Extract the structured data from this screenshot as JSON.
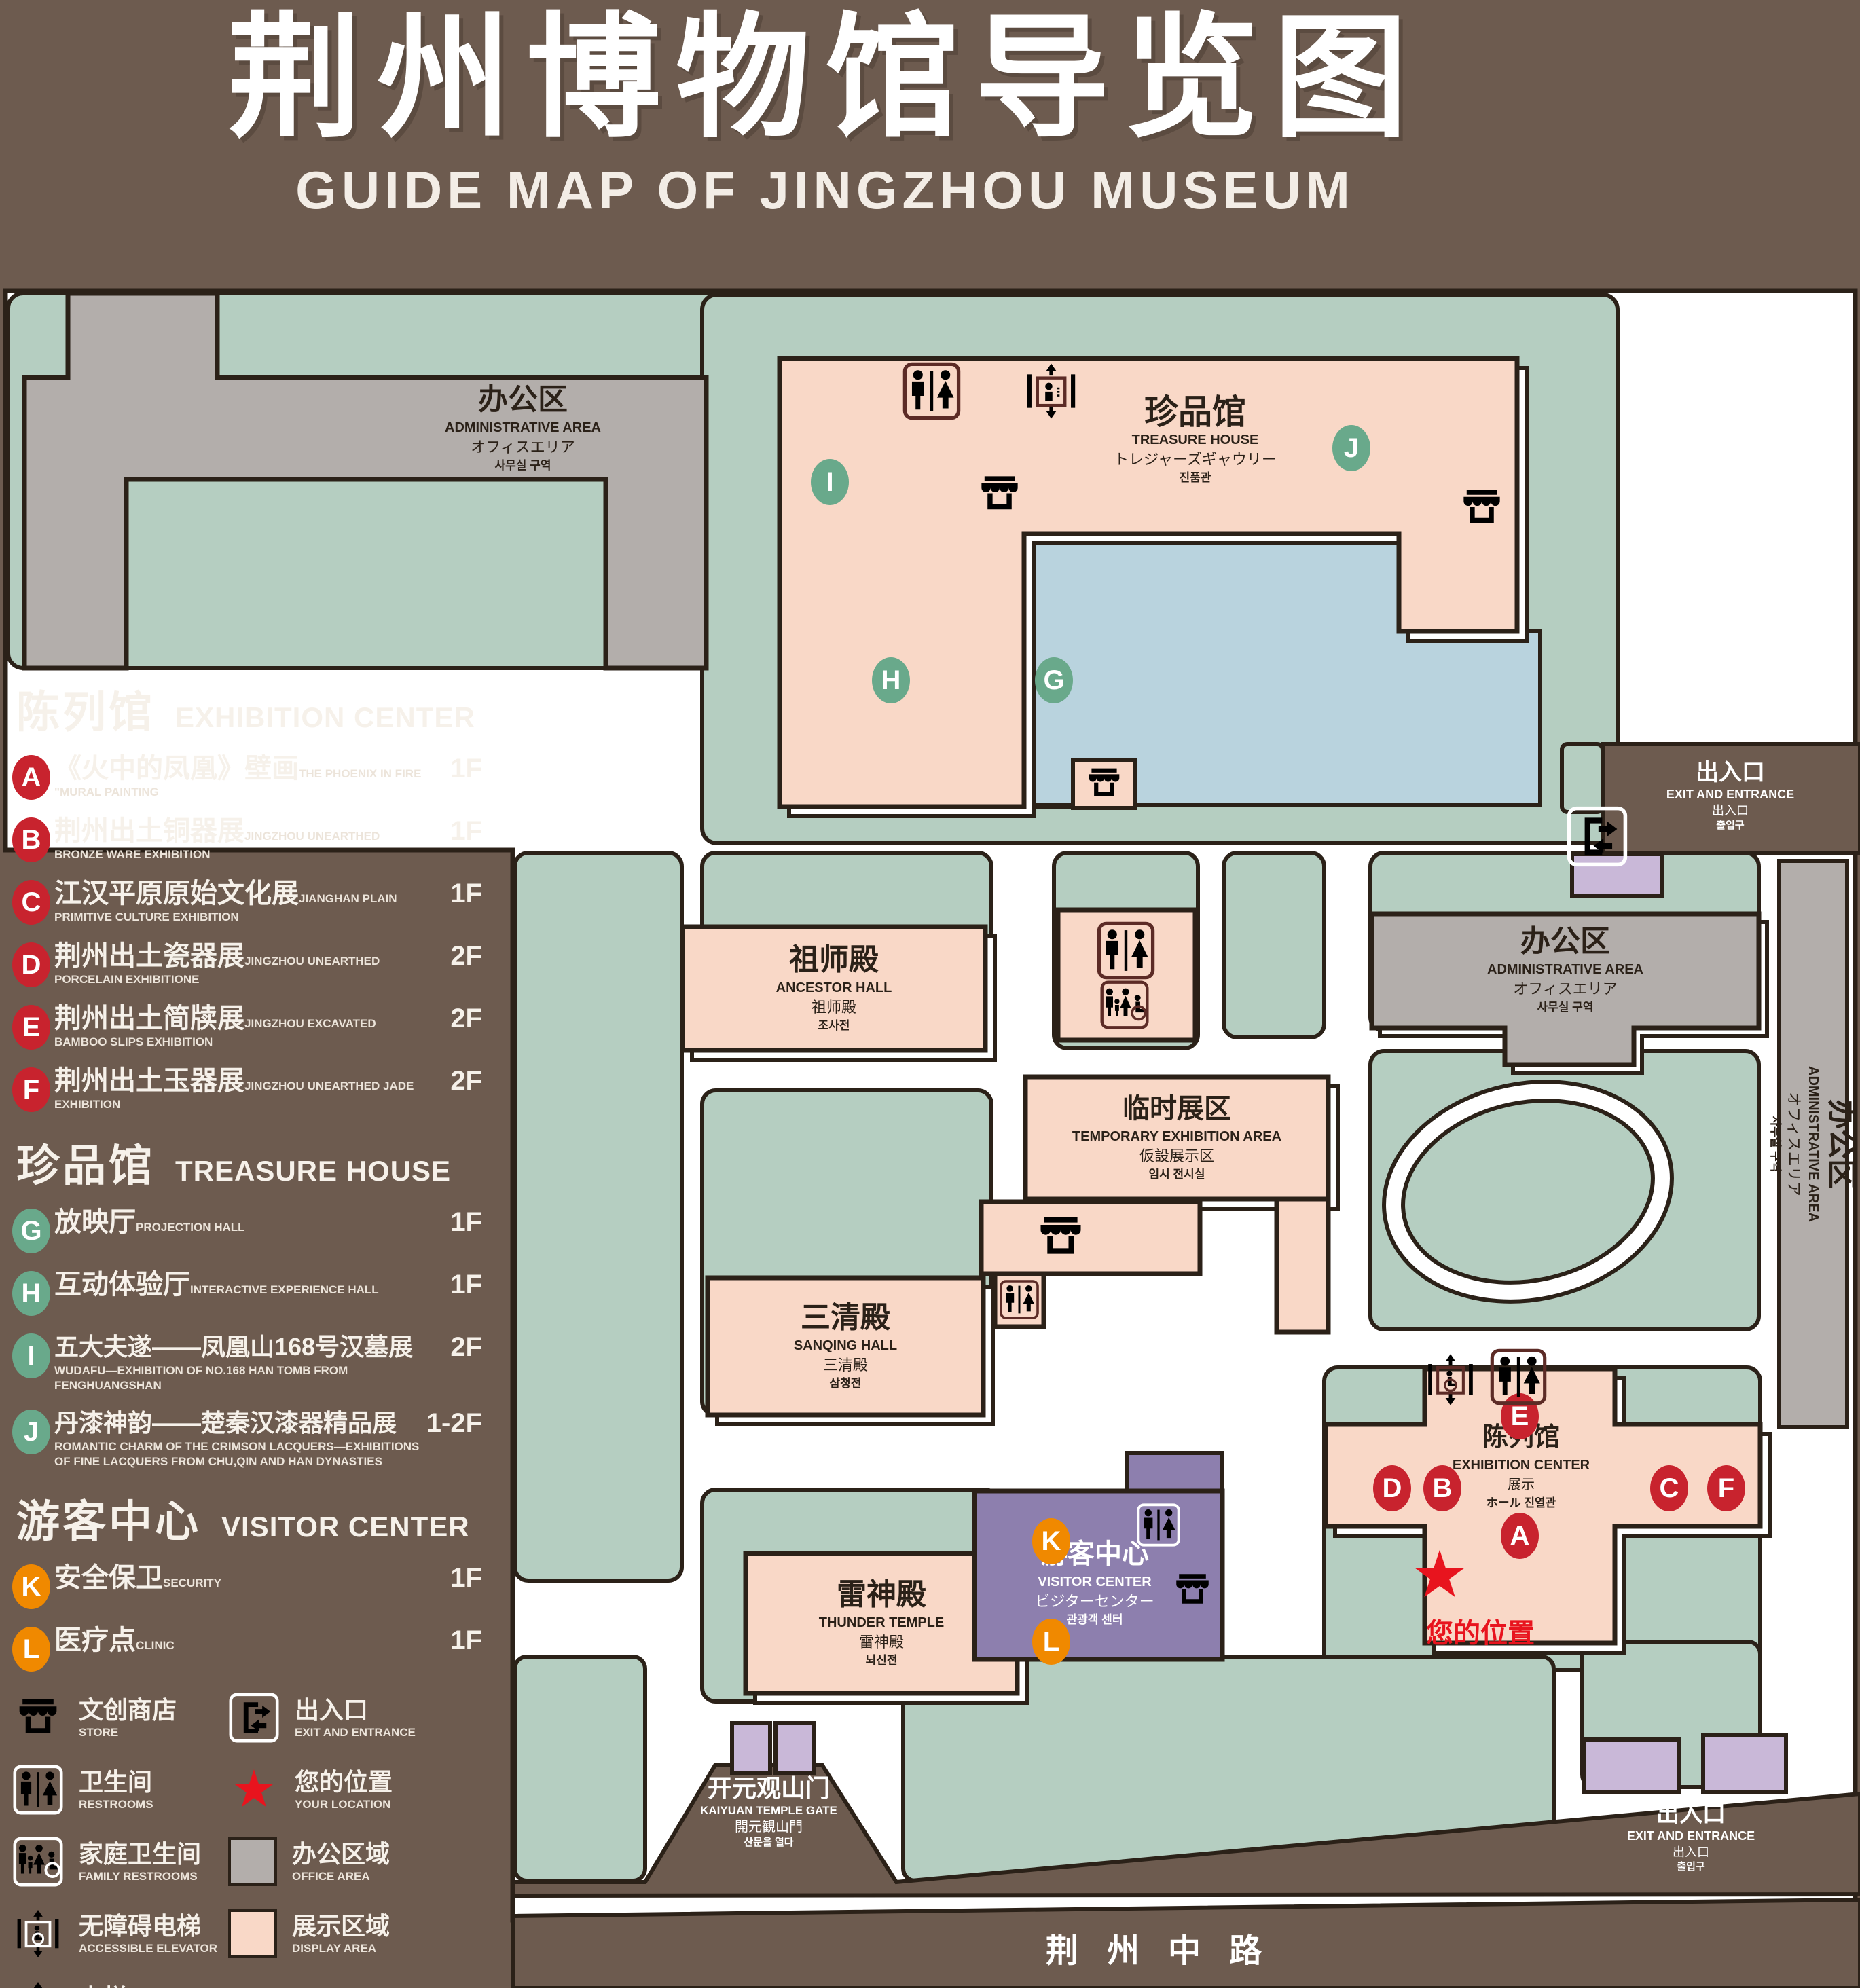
{
  "title": {
    "zh": "荆州博物馆导览图",
    "en": "GUIDE MAP OF JINGZHOU MUSEUM"
  },
  "colors": {
    "background": "#6d5b4f",
    "courtyard_green": "#b5cec1",
    "display_area_pink": "#f9d8c7",
    "office_area_gray": "#b3aeab",
    "pond_blue": "#b9d3de",
    "visitor_center_purple": "#8d7fae",
    "small_building_lavender": "#c9b8d8",
    "badge_red": "#c8232e",
    "badge_green": "#69a98b",
    "badge_orange": "#f08900",
    "outline": "#2b2118",
    "icon_maroon": "#5c2b26",
    "location_red": "#e8141e"
  },
  "legend": {
    "sections": [
      {
        "zh": "陈列馆",
        "en": "EXHIBITION CENTER",
        "items": [
          {
            "key": "A",
            "zh": "《火中的凤凰》壁画",
            "en": "THE PHOENIX IN FIRE \"MURAL PAINTING",
            "floor": "1F"
          },
          {
            "key": "B",
            "zh": "荆州出土铜器展",
            "en": "JINGZHOU UNEARTHED BRONZE WARE EXHIBITION",
            "floor": "1F"
          },
          {
            "key": "C",
            "zh": "江汉平原原始文化展",
            "en": "JIANGHAN PLAIN PRIMITIVE CULTURE EXHIBITION",
            "floor": "1F"
          },
          {
            "key": "D",
            "zh": "荆州出土瓷器展",
            "en": "JINGZHOU UNEARTHED PORCELAIN EXHIBITIONE",
            "floor": "2F"
          },
          {
            "key": "E",
            "zh": "荆州出土简牍展",
            "en": "JINGZHOU EXCAVATED BAMBOO SLIPS EXHIBITION",
            "floor": "2F"
          },
          {
            "key": "F",
            "zh": "荆州出土玉器展",
            "en": "JINGZHOU UNEARTHED JADE EXHIBITION",
            "floor": "2F"
          }
        ]
      },
      {
        "zh": "珍品馆",
        "en": "TREASURE HOUSE",
        "items": [
          {
            "key": "G",
            "zh": "放映厅",
            "en": "PROJECTION HALL",
            "floor": "1F"
          },
          {
            "key": "H",
            "zh": "互动体验厅",
            "en": "INTERACTIVE EXPERIENCE HALL",
            "floor": "1F"
          },
          {
            "key": "I",
            "zh": "五大夫遂——凤凰山168号汉墓展",
            "en": "WUDAFU—EXHIBITION OF NO.168 HAN TOMB FROM FENGHUANGSHAN",
            "floor": "2F"
          },
          {
            "key": "J",
            "zh": "丹漆神韵——楚秦汉漆器精品展",
            "en": "ROMANTIC CHARM OF THE CRIMSON LACQUERS—EXHIBITIONS OF FINE LACQUERS FROM CHU,QIN AND HAN DYNASTIES",
            "floor": "1-2F"
          }
        ]
      },
      {
        "zh": "游客中心",
        "en": "VISITOR CENTER",
        "items": [
          {
            "key": "K",
            "zh": "安全保卫",
            "en": "SECURITY",
            "floor": "1F"
          },
          {
            "key": "L",
            "zh": "医疗点",
            "en": "CLINIC",
            "floor": "1F"
          }
        ]
      }
    ],
    "symbols": [
      {
        "icon": "store",
        "zh": "文创商店",
        "en": "STORE"
      },
      {
        "icon": "exit",
        "zh": "出入口",
        "en": "EXIT AND ENTRANCE"
      },
      {
        "icon": "restrooms",
        "zh": "卫生间",
        "en": "RESTROOMS"
      },
      {
        "icon": "your-location",
        "zh": "您的位置",
        "en": "YOUR LOCATION"
      },
      {
        "icon": "family-restrooms",
        "zh": "家庭卫生间",
        "en": "FAMILY RESTROOMS"
      },
      {
        "icon": "office-area",
        "zh": "办公区域",
        "en": "OFFICE AREA"
      },
      {
        "icon": "accessible-elevator",
        "zh": "无障碍电梯",
        "en": "ACCESSIBLE ELEVATOR"
      },
      {
        "icon": "display-area",
        "zh": "展示区域",
        "en": "DISPLAY AREA"
      },
      {
        "icon": "elevator",
        "zh": "电梯",
        "en": "Elevator"
      }
    ]
  },
  "map": {
    "labels": {
      "admin": {
        "zh": "办公区",
        "en": "ADMINISTRATIVE AREA",
        "ja": "オフィスエリア",
        "ko": "사무실 구역"
      },
      "treasure": {
        "zh": "珍品馆",
        "en": "TREASURE HOUSE",
        "ja": "トレジャーズギャウリー",
        "ko": "진품관"
      },
      "ancestor": {
        "zh": "祖师殿",
        "en": "ANCESTOR HALL",
        "ja": "祖师殿",
        "ko": "조사전"
      },
      "temporary": {
        "zh": "临时展区",
        "en": "TEMPORARY EXHIBITION AREA",
        "ja": "仮設展示区",
        "ko": "임시 전시실"
      },
      "sanqing": {
        "zh": "三清殿",
        "en": "SANQING HALL",
        "ja": "三清殿",
        "ko": "삼청전"
      },
      "thunder": {
        "zh": "雷神殿",
        "en": "THUNDER TEMPLE",
        "ja": "雷神殿",
        "ko": "뇌신전"
      },
      "visitor": {
        "zh": "游客中心",
        "en": "VISITOR CENTER",
        "ja": "ビジターセンター",
        "ko": "관광객 센터"
      },
      "exhibition": {
        "zh": "陈列馆",
        "en": "EXHIBITION CENTER",
        "ja": "展示",
        "ko": "ホール 진열관"
      },
      "gate": {
        "zh": "开元观山门",
        "en": "KAIYUAN TEMPLE GATE",
        "ja": "開元観山門",
        "ko": "산문을 열다"
      },
      "exit": {
        "zh": "出入口",
        "en": "EXIT AND ENTRANCE",
        "ja": "出入口",
        "ko": "출입구"
      },
      "road": "荆州中路",
      "your_location": "您的位置"
    }
  }
}
